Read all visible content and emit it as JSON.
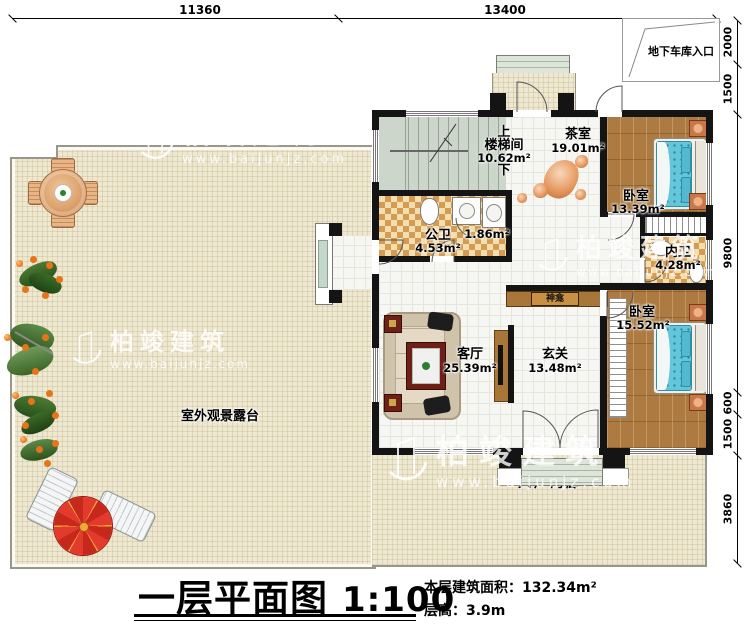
{
  "title_block": {
    "title": "一层平面图",
    "scale": "1:100",
    "area_label": "本层建筑面积：",
    "area_value": "132.34m²",
    "floor_height_label": "层高：",
    "floor_height_value": "3.9m"
  },
  "dimensions": {
    "top": [
      "11360",
      "13400"
    ],
    "right": [
      "2000",
      "1500",
      "9800",
      "600",
      "1500",
      "3860"
    ]
  },
  "annotations": {
    "garage_entrance": "地下车库入口",
    "terrace": "室外观景露台",
    "entry_porch": "入户门廊",
    "shrine": "神龛",
    "stair_up": "上",
    "stair_down": "下"
  },
  "rooms": {
    "stairwell": {
      "name": "楼梯间",
      "area": "10.62m²"
    },
    "tea_room": {
      "name": "茶室",
      "area": "19.01m²"
    },
    "bedroom_top": {
      "name": "卧室",
      "area": "13.39m²"
    },
    "public_bath": {
      "name": "公卫",
      "area": "4.53m²"
    },
    "washroom": {
      "area": "1.86m²"
    },
    "ensuite_bath": {
      "name": "内卫",
      "area": "4.28m²"
    },
    "bedroom_bottom": {
      "name": "卧室",
      "area": "15.52m²"
    },
    "living_room": {
      "name": "客厅",
      "area": "25.39m²"
    },
    "foyer": {
      "name": "玄关",
      "area": "13.48m²"
    }
  },
  "watermark": {
    "brand": "柏竣建筑",
    "url": "www.baijunjz.com"
  },
  "colors": {
    "wall": "#141414",
    "terrace_floor": "#efe8d1",
    "tile_floor": "#f6f6f2",
    "wood_floor": "#ad7b41",
    "checker_dark": "#d49b54",
    "checker_light": "#f3dfae",
    "stair_floor": "#cdd6ca",
    "bed": "#64c6da",
    "umbrella_red": "#d92b20",
    "cabinet_wood": "#a9763a"
  }
}
